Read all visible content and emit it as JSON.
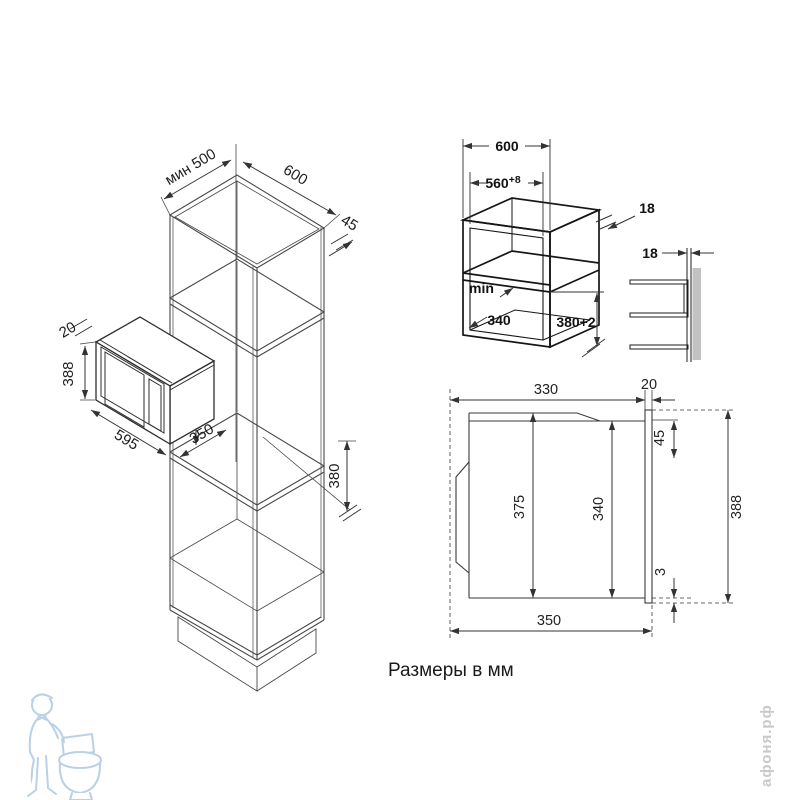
{
  "title": "Размеры в мм",
  "watermark": "афоня.рф",
  "cab": {
    "d500": "мин 500",
    "d600": "600",
    "d45": "45",
    "d20": "20",
    "d515": "515",
    "d388": "388",
    "d375": "375",
    "d595": "595",
    "d350": "350",
    "d380": "380"
  },
  "niche": {
    "d600": "600",
    "d560": "560",
    "d560_tol": "+8",
    "d18_side": "18",
    "d18_wall": "18",
    "min_label": "min",
    "d340": "340",
    "d380": "380+2"
  },
  "section": {
    "d330": "330",
    "d20": "20",
    "d45": "45",
    "d375": "375",
    "d340": "340",
    "d3": "3",
    "d388": "388",
    "d350": "350"
  }
}
